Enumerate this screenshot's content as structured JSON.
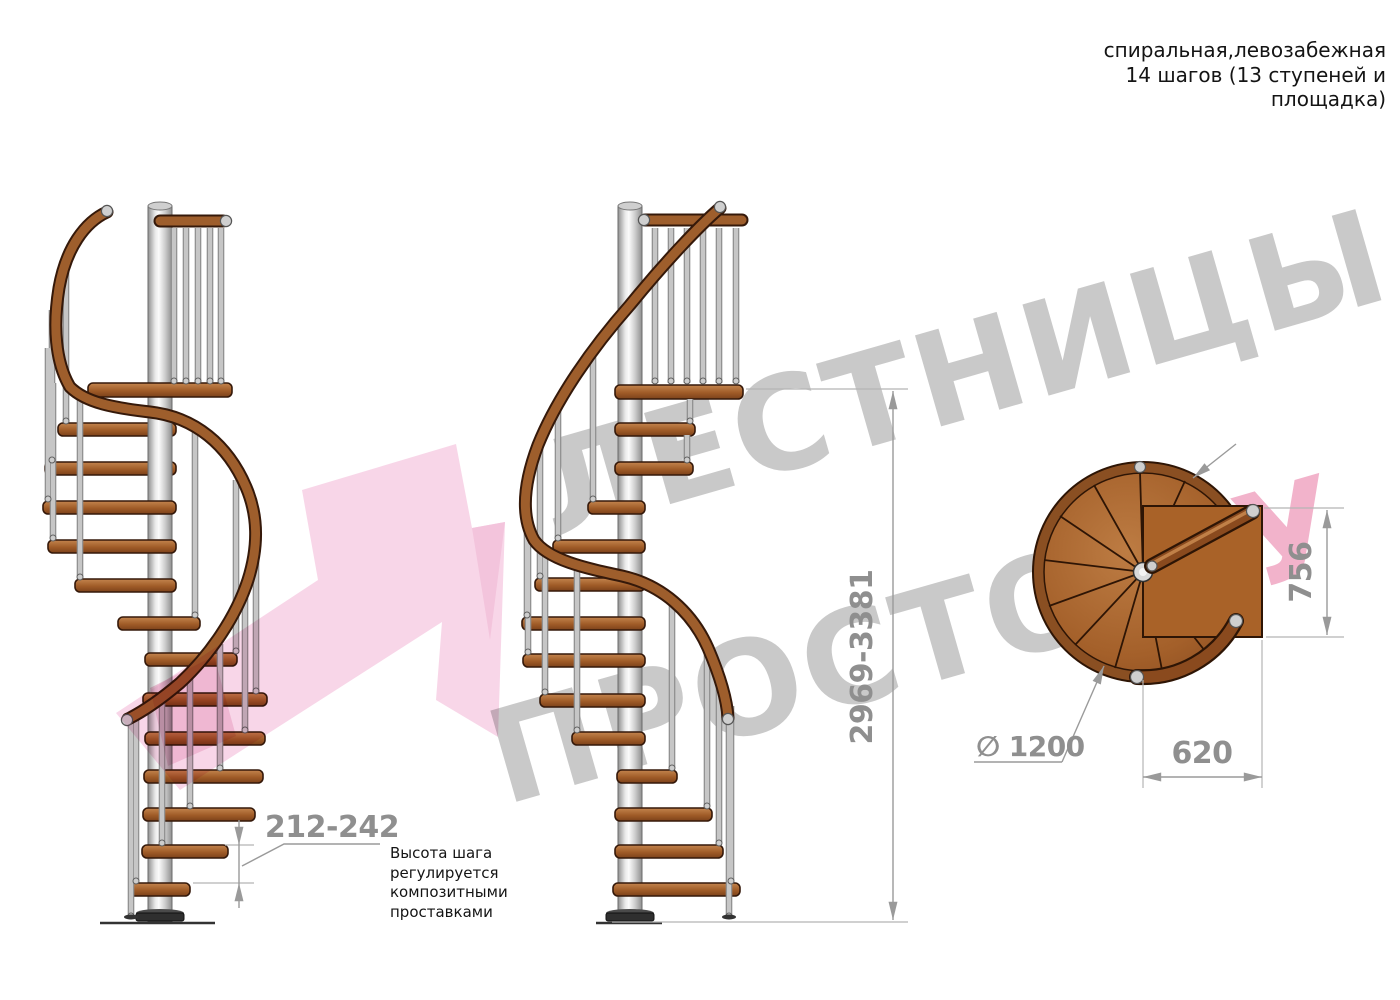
{
  "header": {
    "line1": "спиральная,левозабежная",
    "line2": "14 шагов (13 ступеней и",
    "line3": "площадка)"
  },
  "watermark": {
    "line1": "ЛЕСТНИЦЫ",
    "line2": "ПРОСТО",
    "line2_suffix": ".РУ",
    "gray": "#c9c9c9",
    "pink": "#f2b3cb"
  },
  "note": {
    "line1": "Высота шага",
    "line2": "регулируется",
    "line3": "композитными",
    "line4": "проставками"
  },
  "dimensions": {
    "total_height": "2969-3381",
    "step_height": "212-242",
    "diameter": "∅ 1200",
    "landing_depth": "756",
    "landing_width": "620"
  },
  "colors": {
    "wood": "#a05c28",
    "steel": "#d9d9d9",
    "dimension_text": "#8f8f8f",
    "outline": "#35190a"
  }
}
